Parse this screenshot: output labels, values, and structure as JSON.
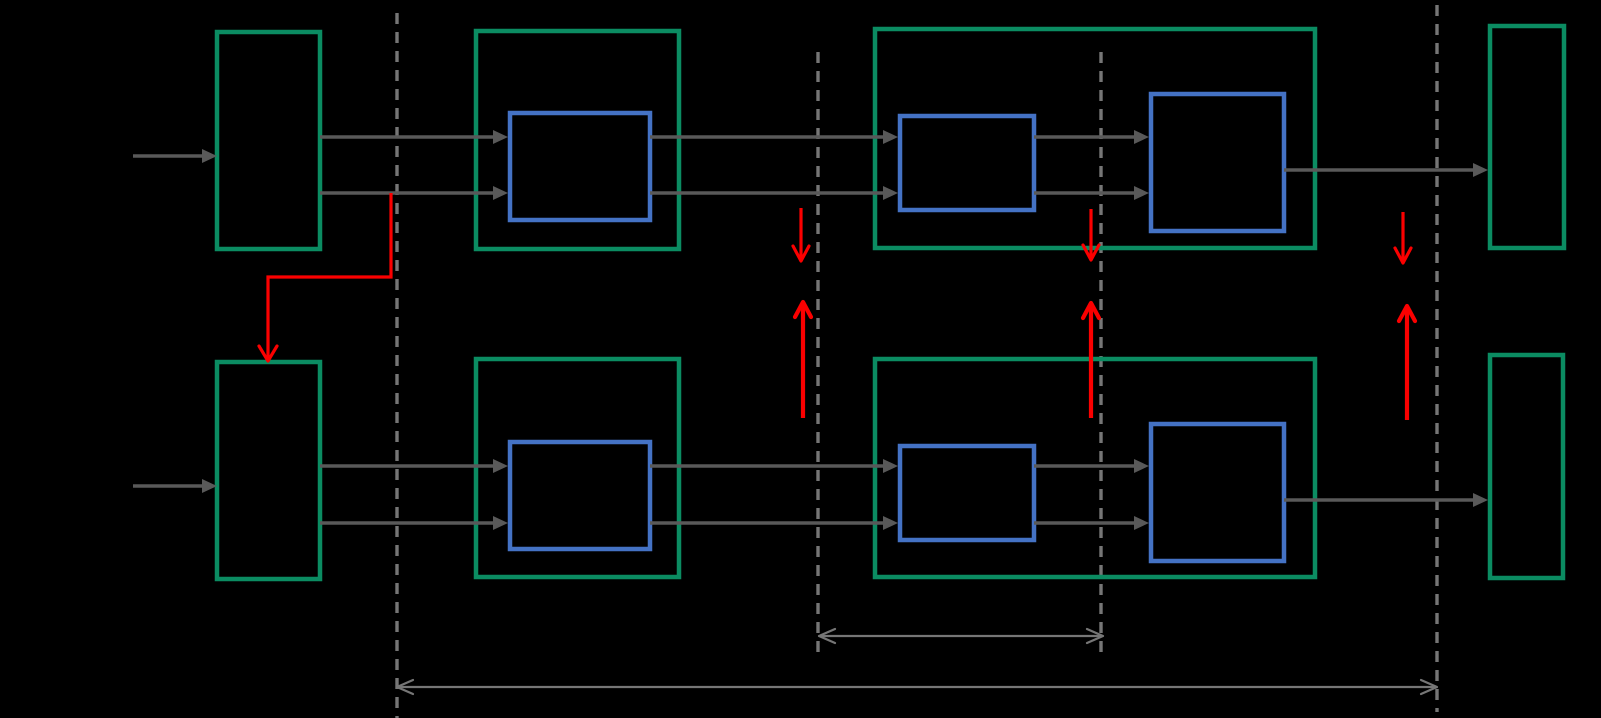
{
  "canvas": {
    "width": 1601,
    "height": 718,
    "background": "#000000"
  },
  "palette": {
    "container_stroke": "#0b8c62",
    "block_stroke": "#4472c4",
    "flow_arrow": "#595959",
    "guide_line": "#767676",
    "dimension_arrow": "#767676",
    "transfer_arrow": "#fb0000"
  },
  "stroke_widths": {
    "container": 4.5,
    "block": 4.5,
    "flow": 3.5,
    "guide": 3.4,
    "dimension": 2.2,
    "transfer_down": 3.2,
    "transfer_up": 4.2,
    "connector": 3.2
  },
  "containers": [
    {
      "name": "upper-input-register",
      "x": 217,
      "y": 32,
      "w": 103,
      "h": 217
    },
    {
      "name": "upper-stage1-container",
      "x": 476,
      "y": 31,
      "w": 203,
      "h": 218
    },
    {
      "name": "upper-stage2-container",
      "x": 875,
      "y": 29,
      "w": 440,
      "h": 219
    },
    {
      "name": "upper-output-register",
      "x": 1490,
      "y": 26,
      "w": 74,
      "h": 222
    },
    {
      "name": "lower-input-register",
      "x": 217,
      "y": 362,
      "w": 103,
      "h": 217
    },
    {
      "name": "lower-stage1-container",
      "x": 476,
      "y": 359,
      "w": 203,
      "h": 218
    },
    {
      "name": "lower-stage2-container",
      "x": 875,
      "y": 359,
      "w": 440,
      "h": 218
    },
    {
      "name": "lower-output-register",
      "x": 1490,
      "y": 355,
      "w": 73,
      "h": 223
    }
  ],
  "blocks": [
    {
      "name": "upper-stage1-block",
      "x": 510,
      "y": 113,
      "w": 140,
      "h": 107
    },
    {
      "name": "upper-stage2-block-a",
      "x": 900,
      "y": 116,
      "w": 134,
      "h": 94
    },
    {
      "name": "upper-stage2-block-b",
      "x": 1151,
      "y": 94,
      "w": 133,
      "h": 137
    },
    {
      "name": "lower-stage1-block",
      "x": 510,
      "y": 442,
      "w": 140,
      "h": 107
    },
    {
      "name": "lower-stage2-block-a",
      "x": 900,
      "y": 446,
      "w": 134,
      "h": 94
    },
    {
      "name": "lower-stage2-block-b",
      "x": 1151,
      "y": 424,
      "w": 133,
      "h": 137
    }
  ],
  "guide_lines": [
    {
      "name": "boundary-line-1",
      "x": 397,
      "y1": 13,
      "y2": 718
    },
    {
      "name": "boundary-line-2",
      "x": 818,
      "y1": 52,
      "y2": 658
    },
    {
      "name": "boundary-line-3",
      "x": 1101,
      "y1": 52,
      "y2": 658
    },
    {
      "name": "boundary-line-4",
      "x": 1437,
      "y1": 5,
      "y2": 712
    }
  ],
  "flow_arrows": [
    {
      "name": "upper-input-arrow",
      "x1": 133,
      "x2": 217,
      "y": 156
    },
    {
      "name": "upper-reg-to-stage1-top",
      "x1": 320,
      "x2": 508,
      "y": 137
    },
    {
      "name": "upper-reg-to-stage1-bottom",
      "x1": 320,
      "x2": 508,
      "y": 193
    },
    {
      "name": "upper-stage1-to-stage2-top",
      "x1": 650,
      "x2": 898,
      "y": 137
    },
    {
      "name": "upper-stage1-to-stage2-bottom",
      "x1": 650,
      "x2": 898,
      "y": 193
    },
    {
      "name": "upper-block-a-to-b-top",
      "x1": 1034,
      "x2": 1149,
      "y": 137
    },
    {
      "name": "upper-block-a-to-b-bottom",
      "x1": 1034,
      "x2": 1149,
      "y": 193
    },
    {
      "name": "upper-output-arrow",
      "x1": 1284,
      "x2": 1488,
      "y": 170
    },
    {
      "name": "lower-input-arrow",
      "x1": 133,
      "x2": 217,
      "y": 486
    },
    {
      "name": "lower-reg-to-stage1-top",
      "x1": 320,
      "x2": 508,
      "y": 466
    },
    {
      "name": "lower-reg-to-stage1-bottom",
      "x1": 320,
      "x2": 508,
      "y": 523
    },
    {
      "name": "lower-stage1-to-stage2-top",
      "x1": 650,
      "x2": 898,
      "y": 466
    },
    {
      "name": "lower-stage1-to-stage2-bottom",
      "x1": 650,
      "x2": 898,
      "y": 523
    },
    {
      "name": "lower-block-a-to-b-top",
      "x1": 1034,
      "x2": 1149,
      "y": 466
    },
    {
      "name": "lower-block-a-to-b-bottom",
      "x1": 1034,
      "x2": 1149,
      "y": 523
    },
    {
      "name": "lower-output-arrow",
      "x1": 1284,
      "x2": 1488,
      "y": 500
    }
  ],
  "transfer_arrows": [
    {
      "name": "transfer-down-1",
      "x": 801,
      "y1": 208,
      "y2": 261,
      "dir": "down"
    },
    {
      "name": "transfer-up-1",
      "x": 803,
      "y1": 418,
      "y2": 302,
      "dir": "up"
    },
    {
      "name": "transfer-down-2",
      "x": 1091,
      "y1": 209,
      "y2": 260,
      "dir": "down"
    },
    {
      "name": "transfer-up-2",
      "x": 1091,
      "y1": 418,
      "y2": 303,
      "dir": "up"
    },
    {
      "name": "transfer-down-3",
      "x": 1403,
      "y1": 212,
      "y2": 263,
      "dir": "down"
    },
    {
      "name": "transfer-up-3",
      "x": 1407,
      "y1": 420,
      "y2": 306,
      "dir": "up"
    }
  ],
  "cross_connector": {
    "name": "upper-to-lower-feed-connector",
    "points": [
      [
        391,
        193
      ],
      [
        391,
        277
      ],
      [
        268,
        277
      ],
      [
        268,
        358
      ]
    ],
    "head_tip": [
      268,
      361
    ]
  },
  "dimension_arrows": [
    {
      "name": "stage-span-indicator",
      "x1": 819,
      "x2": 1103,
      "y": 636
    },
    {
      "name": "pipeline-span-indicator",
      "x1": 397,
      "x2": 1437,
      "y": 687
    }
  ]
}
